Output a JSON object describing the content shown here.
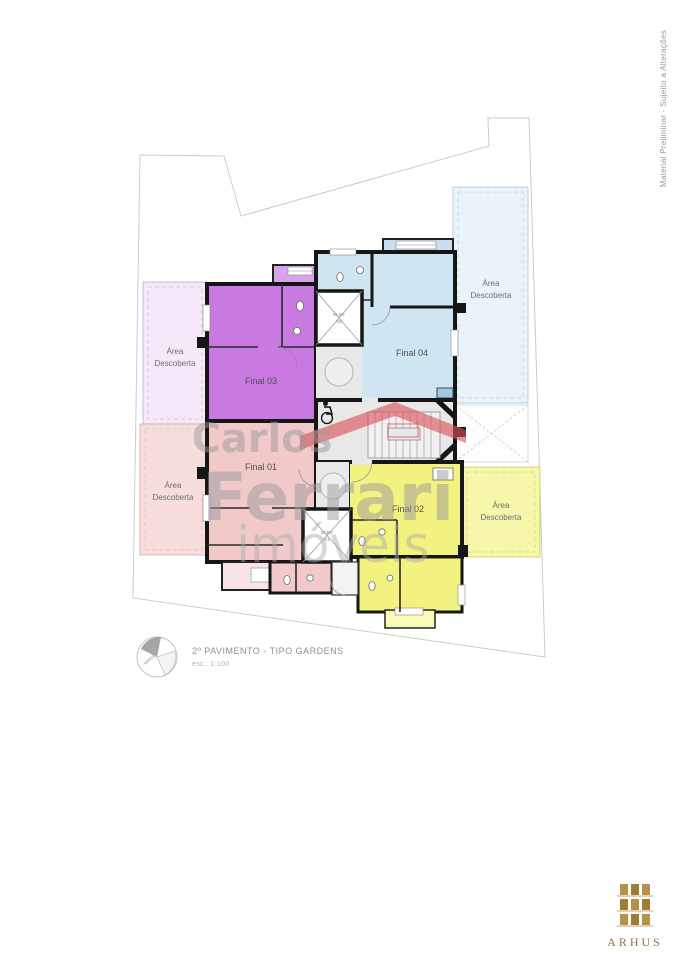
{
  "side_note": {
    "text": "Material Preliminar - Sujeito a Alterações"
  },
  "title_block": {
    "title": "2º PAVIMENTO - TIPO GARDENS",
    "scale": "esc.: 1:100",
    "compass_label": "NORTE"
  },
  "watermark": {
    "line1": "Carlos",
    "line2": "Ferrari",
    "line3": "imóveis",
    "text_color": "#9a9a9a",
    "roof_color": "#d95059"
  },
  "brand": {
    "name": "ARHUS",
    "gold": "#b5914b",
    "text_color": "#8f7338"
  },
  "plan": {
    "open_area_label": {
      "line1": "Área",
      "line2": "Descoberta"
    },
    "units": [
      {
        "id": "final-01",
        "label": "Final 01",
        "color": "#f2c9c9"
      },
      {
        "id": "final-02",
        "label": "Final 02",
        "color": "#f2f280"
      },
      {
        "id": "final-03",
        "label": "Final 03",
        "color": "#c879e2"
      },
      {
        "id": "final-04",
        "label": "Final 04",
        "color": "#cfe5f2"
      }
    ],
    "elevators": [
      {
        "id": "elev-01",
        "line1": "ELEV",
        "line2": "01"
      },
      {
        "id": "elev-03",
        "line1": "ELEV",
        "line2": "03"
      }
    ]
  }
}
